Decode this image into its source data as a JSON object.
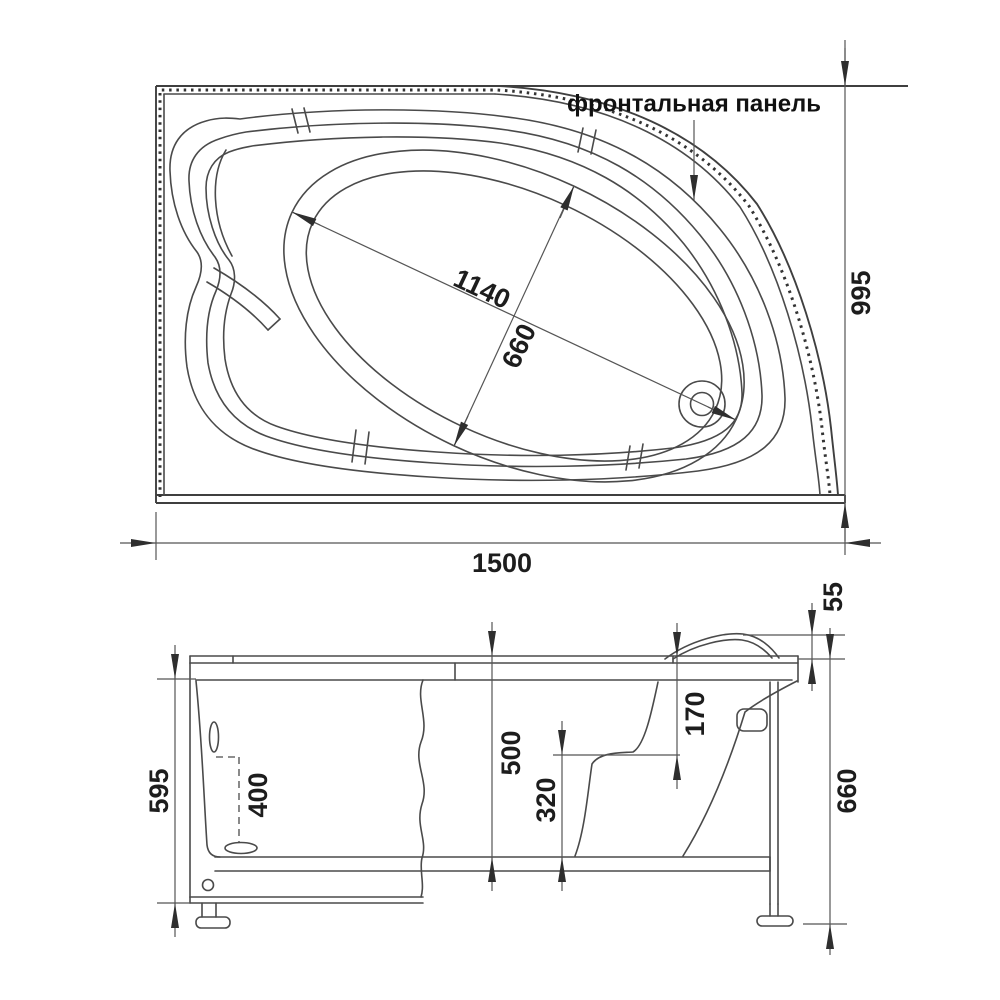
{
  "annotation": {
    "frontal_panel": "фронтальная панель"
  },
  "top_view": {
    "width": "1500",
    "height": "995",
    "basin_length": "1140",
    "basin_width": "660"
  },
  "side_view": {
    "body_height": "595",
    "overflow_height": "400",
    "depth": "500",
    "seat_height": "320",
    "rim_to_seat": "170",
    "rim_edge": "55",
    "total_height": "660"
  },
  "colors": {
    "background": "#ffffff",
    "line": "#4a4a4a",
    "text": "#1d1d1d"
  }
}
